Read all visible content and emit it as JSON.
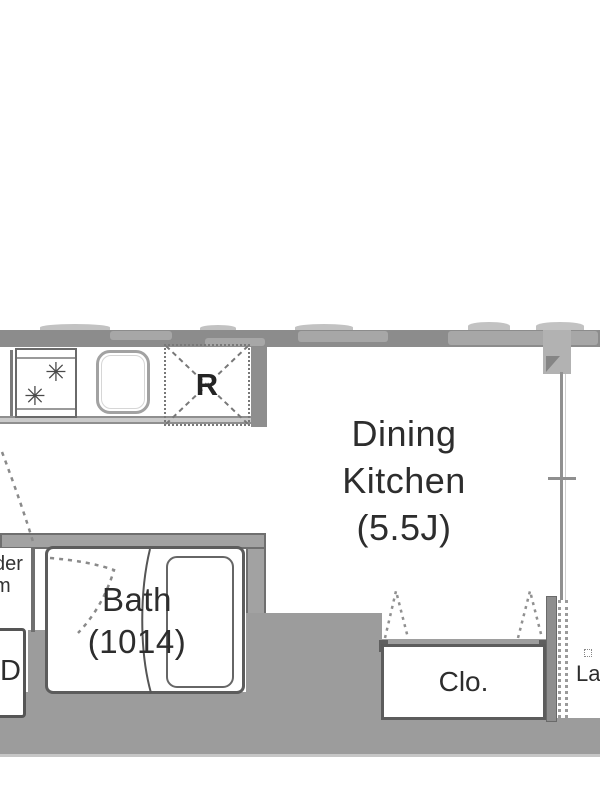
{
  "plan": {
    "rooms": {
      "dining_kitchen": {
        "name_line1": "Dining",
        "name_line2": "Kitchen",
        "size": "(5.5J)"
      },
      "bath": {
        "name": "Bath",
        "size": "(1014)"
      },
      "closet": {
        "label": "Clo."
      },
      "refrigerator": {
        "label": "R"
      },
      "powder_room_fragment": {
        "line1": "der",
        "line2": "m"
      },
      "washer_fragment": {
        "label": "D"
      },
      "laundry_fragment": {
        "label": "La"
      }
    },
    "icons": {
      "burner_glyph": "✳"
    },
    "colors": {
      "wall": "#8e8e8e",
      "wall_fill": "#9c9c9c",
      "outline": "#5a5a5a",
      "dashed": "#8a8a8a",
      "text": "#2d2d2d",
      "floor": "#ffffff"
    }
  }
}
